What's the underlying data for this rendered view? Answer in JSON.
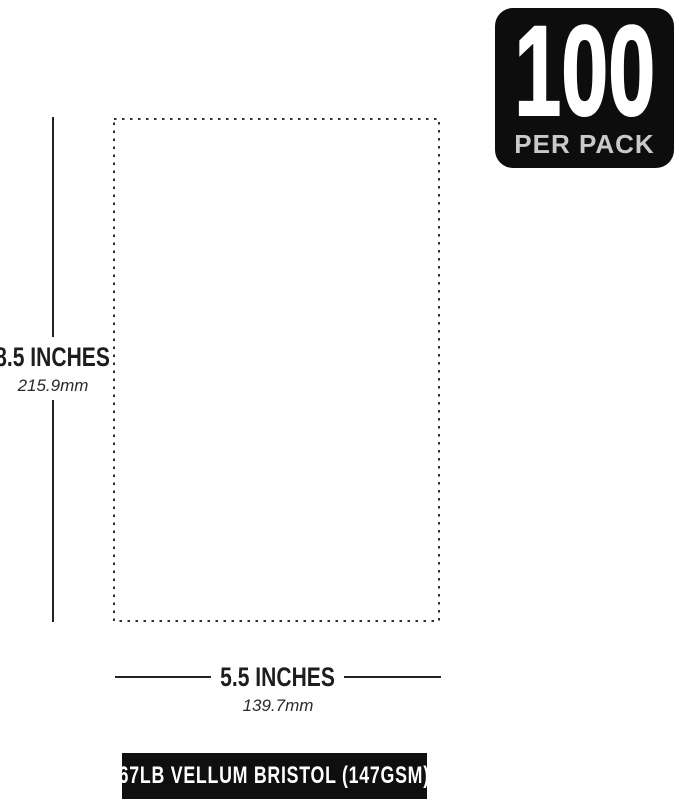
{
  "badge": {
    "count": "100",
    "label": "PER PACK",
    "bg_color": "#0d0d0d",
    "count_color": "#ffffff",
    "label_color": "#c9c9c9"
  },
  "sheet": {
    "height_label": "8.5 INCHES",
    "height_metric": "215.9mm",
    "width_label": "5.5 INCHES",
    "width_metric": "139.7mm",
    "outline_style": "dotted",
    "outline_color": "#2e2e2e"
  },
  "footer": {
    "label": "67LB VELLUM BRISTOL (147GSM)",
    "bg_color": "#0f0f0f",
    "text_color": "#ffffff"
  },
  "colors": {
    "background": "#ffffff",
    "dimension_text": "#1d1d1d",
    "dimension_line": "#222222"
  }
}
